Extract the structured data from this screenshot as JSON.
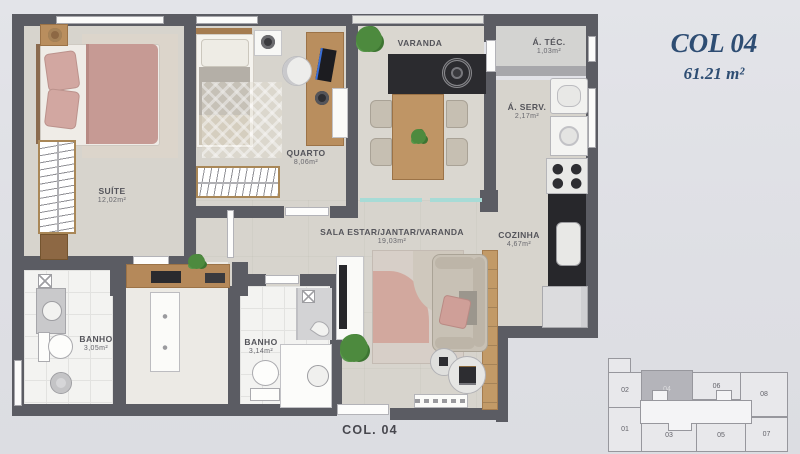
{
  "header": {
    "unit_name": "COL 04",
    "unit_area": "61.21 m²"
  },
  "plan": {
    "bottom_label": "COL. 04",
    "rooms": {
      "suite": {
        "label": "SUÍTE",
        "area": "12,02m²"
      },
      "quarto": {
        "label": "QUARTO",
        "area": "8,06m²"
      },
      "varanda": {
        "label": "VARANDA"
      },
      "area_tecnica": {
        "label": "Á. TÉC.",
        "area": "1,03m²"
      },
      "area_servico": {
        "label": "Á. SERV.",
        "area": "2,17m²"
      },
      "cozinha": {
        "label": "COZINHA",
        "area": "4,67m²"
      },
      "sala": {
        "label": "SALA ESTAR/JANTAR/VARANDA",
        "area": "19,03m²"
      },
      "banho_suite": {
        "label": "BANHO",
        "area": "3,05m²"
      },
      "banho_social": {
        "label": "BANHO",
        "area": "3,14m²"
      }
    }
  },
  "keyplan": {
    "highlighted_unit": "04",
    "units": [
      {
        "label": "02"
      },
      {
        "label": "04"
      },
      {
        "label": "06"
      },
      {
        "label": "08"
      },
      {
        "label": "01"
      },
      {
        "label": "03"
      },
      {
        "label": "05"
      },
      {
        "label": "07"
      }
    ]
  },
  "colors": {
    "accent_blue": "#2e4d73",
    "wall_gray": "#5b5c63",
    "highlight_gray": "#b4b4ba",
    "glass_teal": "#a7dbd6"
  }
}
